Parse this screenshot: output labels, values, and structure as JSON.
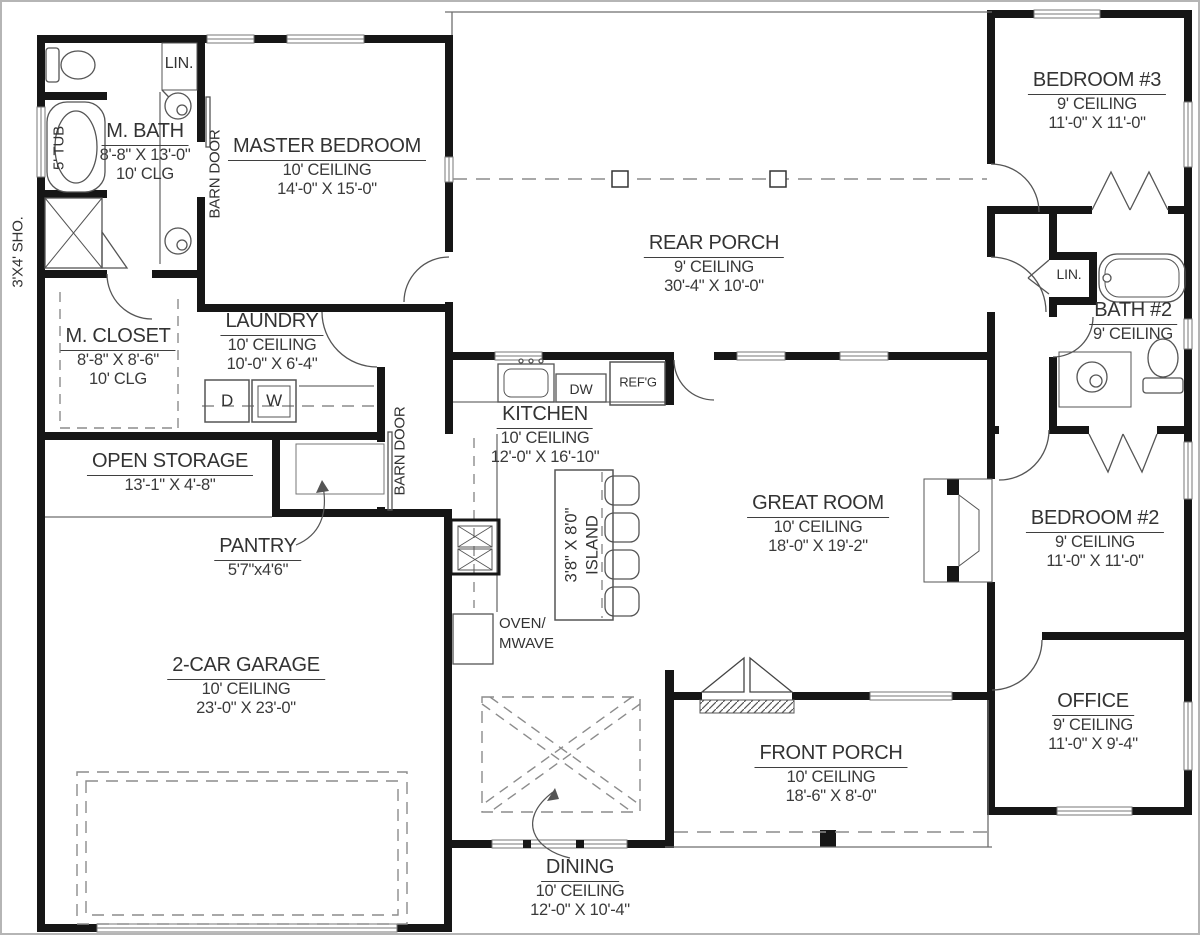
{
  "title": "House Floor Plan",
  "colors": {
    "wall": "#161616",
    "text": "#3a3a3a",
    "thin_line": "#6e6e6e",
    "dash": "#8c8c8c",
    "border": "#b5b5b5"
  },
  "rooms": {
    "m_bath": {
      "name": "M. BATH",
      "line2": "8'-8\" X 13'-0\"",
      "line3": "10' CLG"
    },
    "master_bedroom": {
      "name": "MASTER BEDROOM",
      "line2": "10' CEILING",
      "line3": "14'-0\" X 15'-0\""
    },
    "rear_porch": {
      "name": "REAR PORCH",
      "line2": "9' CEILING",
      "line3": "30'-4\" X 10'-0\""
    },
    "bedroom3": {
      "name": "BEDROOM #3",
      "line2": "9' CEILING",
      "line3": "11'-0\" X 11'-0\""
    },
    "bath2": {
      "name": "BATH #2",
      "line2": "9' CEILING"
    },
    "m_closet": {
      "name": "M. CLOSET",
      "line2": "8'-8\" X 8'-6\"",
      "line3": "10' CLG"
    },
    "laundry": {
      "name": "LAUNDRY",
      "line2": "10' CEILING",
      "line3": "10'-0\" X 6'-4\""
    },
    "kitchen": {
      "name": "KITCHEN",
      "line2": "10' CEILING",
      "line3": "12'-0\" X 16'-10\""
    },
    "open_storage": {
      "name": "OPEN STORAGE",
      "line2": "13'-1\" X 4'-8\""
    },
    "pantry": {
      "name": "PANTRY",
      "line2": "5'7\"x4'6\""
    },
    "great_room": {
      "name": "GREAT ROOM",
      "line2": "10' CEILING",
      "line3": "18'-0\" X 19'-2\""
    },
    "bedroom2": {
      "name": "BEDROOM #2",
      "line2": "9' CEILING",
      "line3": "11'-0\" X 11'-0\""
    },
    "garage": {
      "name": "2-CAR GARAGE",
      "line2": "10' CEILING",
      "line3": "23'-0\" X 23'-0\""
    },
    "front_porch": {
      "name": "FRONT PORCH",
      "line2": "10' CEILING",
      "line3": "18'-6\" X 8'-0\""
    },
    "office": {
      "name": "OFFICE",
      "line2": "9' CEILING",
      "line3": "11'-0\" X 9'-4\""
    },
    "dining": {
      "name": "DINING",
      "line2": "10' CEILING",
      "line3": "12'-0\" X 10'-4\""
    }
  },
  "fixtures": {
    "island_line1": "3'8\" X 8'0\"",
    "island_line2": "ISLAND",
    "barn_door": "BARN DOOR",
    "shower": "3'X4' SHO.",
    "tub": "5' TUB",
    "linen": "LIN.",
    "dryer": "D",
    "washer": "W",
    "dishwasher": "DW",
    "fridge": "REF'G",
    "oven_line1": "OVEN/",
    "oven_line2": "MWAVE"
  }
}
